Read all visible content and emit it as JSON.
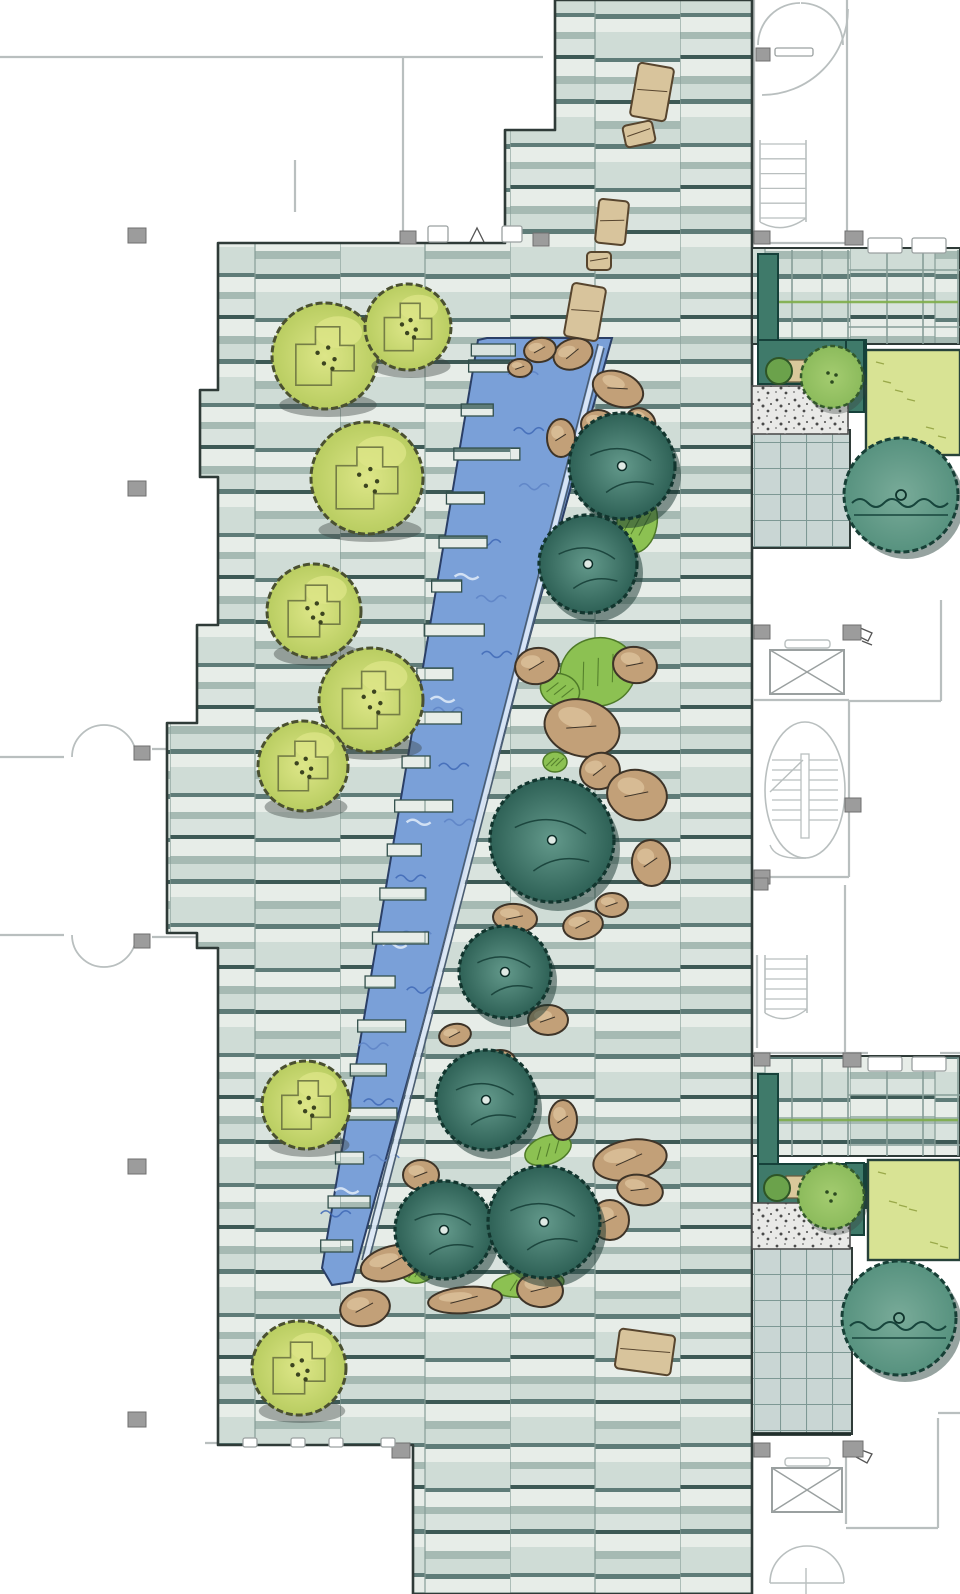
{
  "scene": {
    "width": 960,
    "height": 1594,
    "palette": {
      "paper": "#ffffff",
      "wall_line": "#b9bfbf",
      "wall_dark": "#9aa0a0",
      "column_fill": "#9c9c9c",
      "column_stroke": "#6f6f6f",
      "plaza_border": "#2f3b38",
      "band_base": "#d9e3de",
      "band_light": "#e7ede8",
      "band_mid": "#cfdcd6",
      "band_deep": "#a6bab3",
      "band_dark": "#5f7c78",
      "band_vdark": "#3d5955",
      "joint": "#869d97",
      "grid_base": "#c9d6d4",
      "grid_line": "#7d9894",
      "water": "#7aa0d8",
      "water_dark": "#3f69b6",
      "water_mid": "#5d83c6",
      "water_light": "#dce8f7",
      "water_border": "#2b3f66",
      "runnel": "#4a5d73",
      "stone_fill": "#d8c49c",
      "stone_stroke": "#57452e",
      "rock_fill": "#c2a078",
      "rock_light": "#dcc29b",
      "rock_stroke": "#3e3428",
      "grass": "#8cc152",
      "grass_stroke": "#4e7a28",
      "grass_hatch": "#55812c",
      "ltree_fill": "#b9cd61",
      "ltree_light": "#dde688",
      "ltree_stroke": "#4a5030",
      "ltree_detail": "#6b7340",
      "dtree_light": "#63998b",
      "dtree_fill": "#2e6156",
      "dtree_stroke": "#12352e",
      "mtree_fill": "#8cbb5c",
      "mtree_stroke": "#33592b",
      "btree_fill": "#57927f",
      "btree_stroke": "#173f36",
      "hedge": "#3f7a6a",
      "hedge_stroke": "#16413a",
      "lawn": "#d8e394",
      "lawn_stroke": "#9aa94a",
      "bed": "#d9c89b",
      "bed_stroke": "#6b5b3c",
      "gravel_base": "#e9e9e7",
      "gravel_dot": "#4a4a4a",
      "gravel_dot2": "#8a8a8a",
      "shadow_light": "#3a413f",
      "shadow_dark": "#16332d",
      "green_joint": "#7fae4a",
      "glyph": "#555555"
    },
    "plaza_outline": "555,0 752,0 752,1594 413,1594 413,1445 218,1445 218,948 197,948 197,933 167,933 167,723 197,723 197,625 218,625 218,477 200,477 200,390 218,390 218,243 505,243 505,130 555,130",
    "stream": {
      "polygon": "487,338 612,338 352,1282 332,1285 322,1268 478,340",
      "left_top": [
        478,
        340
      ],
      "left_bottom": [
        322,
        1268
      ],
      "teeth": [
        [
          344,
          36
        ],
        [
          360,
          46
        ],
        [
          404,
          24
        ],
        [
          448,
          58
        ],
        [
          492,
          30
        ],
        [
          536,
          40
        ],
        [
          580,
          22
        ],
        [
          624,
          52
        ],
        [
          668,
          28
        ],
        [
          712,
          44
        ],
        [
          756,
          20
        ],
        [
          800,
          50
        ],
        [
          844,
          26
        ],
        [
          888,
          38
        ],
        [
          932,
          48
        ],
        [
          976,
          22
        ],
        [
          1020,
          40
        ],
        [
          1064,
          28
        ],
        [
          1108,
          46
        ],
        [
          1152,
          20
        ],
        [
          1196,
          34
        ],
        [
          1240,
          24
        ]
      ],
      "runnel_light": [
        601,
        346,
        365,
        1262
      ],
      "runnel_dark": [
        [
          604,
          348,
          368,
          1264
        ],
        [
          598,
          344,
          362,
          1260
        ]
      ]
    },
    "stepping_stones": [
      [
        652,
        92,
        36,
        54,
        10
      ],
      [
        639,
        134,
        30,
        22,
        -12
      ],
      [
        612,
        222,
        30,
        44,
        6
      ],
      [
        599,
        261,
        24,
        18,
        0
      ],
      [
        585,
        312,
        34,
        54,
        10
      ],
      [
        645,
        1352,
        56,
        40,
        8
      ]
    ],
    "rocks": [
      [
        573,
        354,
        20,
        15,
        -20
      ],
      [
        618,
        389,
        26,
        17,
        20
      ],
      [
        598,
        424,
        17,
        14,
        0
      ],
      [
        561,
        438,
        14,
        19,
        0
      ],
      [
        641,
        421,
        15,
        12,
        30
      ],
      [
        540,
        350,
        16,
        12,
        -10
      ],
      [
        520,
        368,
        12,
        9,
        0
      ],
      [
        537,
        666,
        22,
        18,
        -10
      ],
      [
        635,
        665,
        22,
        18,
        10
      ],
      [
        582,
        728,
        38,
        28,
        15
      ],
      [
        600,
        771,
        20,
        18,
        -15
      ],
      [
        637,
        795,
        30,
        25,
        10
      ],
      [
        651,
        863,
        19,
        23,
        -5
      ],
      [
        612,
        905,
        16,
        12,
        0
      ],
      [
        583,
        925,
        20,
        14,
        -10
      ],
      [
        515,
        918,
        22,
        14,
        5
      ],
      [
        530,
        955,
        14,
        10,
        0
      ],
      [
        455,
        1035,
        16,
        11,
        -10
      ],
      [
        548,
        1020,
        20,
        15,
        0
      ],
      [
        500,
        1060,
        15,
        10,
        0
      ],
      [
        563,
        1120,
        14,
        20,
        0
      ],
      [
        630,
        1160,
        37,
        20,
        -10
      ],
      [
        640,
        1190,
        23,
        15,
        10
      ],
      [
        610,
        1220,
        19,
        20,
        0
      ],
      [
        540,
        1290,
        23,
        17,
        5
      ],
      [
        465,
        1300,
        37,
        13,
        -5
      ],
      [
        393,
        1263,
        33,
        17,
        -15
      ],
      [
        365,
        1308,
        25,
        18,
        -10
      ],
      [
        421,
        1175,
        18,
        15,
        0
      ]
    ],
    "grass_patches": [
      [
        598,
        672,
        38,
        34,
        -15
      ],
      [
        637,
        523,
        20,
        30,
        10
      ],
      [
        560,
        690,
        20,
        16,
        20
      ],
      [
        555,
        762,
        12,
        10,
        0
      ],
      [
        548,
        1150,
        24,
        14,
        -20
      ],
      [
        418,
        1272,
        16,
        11,
        -10
      ],
      [
        528,
        1284,
        36,
        13,
        -5
      ]
    ],
    "light_trees": [
      [
        325,
        356,
        53
      ],
      [
        408,
        327,
        43
      ],
      [
        367,
        478,
        56
      ],
      [
        314,
        611,
        47
      ],
      [
        371,
        700,
        52
      ],
      [
        303,
        766,
        45
      ],
      [
        306,
        1105,
        44
      ],
      [
        299,
        1368,
        47
      ]
    ],
    "dark_trees": [
      [
        622,
        466,
        53
      ],
      [
        588,
        564,
        49
      ],
      [
        552,
        840,
        62
      ],
      [
        505,
        972,
        46
      ],
      [
        486,
        1100,
        50
      ],
      [
        444,
        1230,
        49
      ],
      [
        544,
        1222,
        56
      ]
    ],
    "medium_trees": [
      [
        832,
        377,
        31
      ],
      [
        831,
        1196,
        33
      ]
    ],
    "big_teal_trees": [
      [
        901,
        495,
        57
      ],
      [
        899,
        1318,
        57
      ]
    ],
    "bushes": [
      [
        779,
        371,
        13
      ],
      [
        777,
        1188,
        13
      ]
    ],
    "hedges": [
      [
        758,
        254,
        20,
        96
      ],
      [
        758,
        340,
        108,
        44
      ],
      [
        846,
        340,
        18,
        72
      ],
      [
        758,
        1074,
        20,
        96
      ],
      [
        758,
        1164,
        108,
        44
      ],
      [
        846,
        1163,
        18,
        72
      ]
    ],
    "lawns": [
      [
        866,
        350,
        94,
        105
      ],
      [
        868,
        1160,
        92,
        100
      ]
    ],
    "planting_beds": [
      [
        782,
        360,
        30,
        22
      ],
      [
        786,
        1176,
        30,
        22
      ]
    ],
    "gravel_patches": [
      [
        752,
        386,
        96,
        48
      ],
      [
        752,
        1203,
        98,
        46
      ]
    ],
    "grid_paving": [
      [
        752,
        430,
        98,
        118
      ],
      [
        752,
        1248,
        100,
        186
      ]
    ],
    "paving_strips": [
      [
        752,
        248,
        208,
        96
      ],
      [
        752,
        1056,
        208,
        100
      ]
    ],
    "strip_vlines": [
      [
        848,
        250,
        344
      ],
      [
        887,
        250,
        344
      ],
      [
        923,
        250,
        344
      ],
      [
        958,
        250,
        344
      ],
      [
        792,
        250,
        344
      ],
      [
        822,
        250,
        344
      ],
      [
        848,
        1058,
        1156
      ],
      [
        887,
        1058,
        1156
      ],
      [
        923,
        1058,
        1156
      ],
      [
        958,
        1058,
        1156
      ],
      [
        792,
        1058,
        1156
      ],
      [
        822,
        1058,
        1156
      ]
    ],
    "strip_hlines": [
      [
        270,
        848,
        960
      ],
      [
        327,
        848,
        960
      ],
      [
        1095,
        848,
        960
      ],
      [
        1145,
        848,
        960
      ]
    ],
    "green_joints": [
      [
        760,
        302,
        958,
        302
      ],
      [
        768,
        1120,
        958,
        1120
      ]
    ],
    "walls": [
      [
        0,
        57,
        543,
        57
      ],
      [
        403,
        57,
        403,
        237
      ],
      [
        295,
        160,
        295,
        212
      ],
      [
        754,
        0,
        754,
        243
      ],
      [
        847,
        0,
        847,
        243
      ],
      [
        754,
        243,
        862,
        243
      ],
      [
        0,
        757,
        64,
        757
      ],
      [
        152,
        749,
        216,
        749
      ],
      [
        0,
        935,
        64,
        935
      ],
      [
        152,
        937,
        216,
        937
      ],
      [
        849,
        700,
        849,
        877
      ],
      [
        754,
        700,
        849,
        700
      ],
      [
        849,
        701,
        941,
        701
      ],
      [
        941,
        600,
        941,
        701
      ],
      [
        754,
        877,
        849,
        877
      ],
      [
        845,
        885,
        845,
        1053
      ],
      [
        757,
        955,
        757,
        1048
      ],
      [
        846,
        1456,
        846,
        1524
      ],
      [
        846,
        1528,
        938,
        1528
      ],
      [
        938,
        1418,
        938,
        1528
      ],
      [
        938,
        1413,
        960,
        1413
      ],
      [
        205,
        1443,
        413,
        1443
      ],
      [
        754,
        1053,
        868,
        1053
      ],
      [
        940,
        1053,
        960,
        1053
      ]
    ],
    "door_arcs": [
      "M72,757 A32,32 0 0 1 104,725",
      "M136,757 A32,32 0 0 0 104,725",
      "M72,935 A32,32 0 0 0 104,967",
      "M136,935 A32,32 0 0 1 104,967",
      "M758,45 A42,42 0 0 1 800,3",
      "M843,45 A42,42 0 0 0 801,3",
      "M762,95 A86,86 0 0 0 848,9",
      "M772,434 A44,44 0 0 0 816,478",
      "M768,1252 A40,40 0 0 0 808,1292",
      "M823,1428 A20,20 0 0 1 843,1408"
    ],
    "wall_tabs": [
      [
        428,
        226,
        20,
        16
      ],
      [
        502,
        226,
        20,
        16
      ],
      [
        775,
        48,
        38,
        8
      ],
      [
        868,
        238,
        34,
        15
      ],
      [
        912,
        238,
        34,
        15
      ],
      [
        868,
        1057,
        34,
        14
      ],
      [
        912,
        1057,
        34,
        14
      ],
      [
        243,
        1438,
        14,
        9
      ],
      [
        291,
        1438,
        14,
        9
      ],
      [
        329,
        1438,
        14,
        9
      ],
      [
        381,
        1438,
        14,
        9
      ]
    ],
    "columns": [
      [
        400,
        231,
        16,
        13
      ],
      [
        533,
        233,
        16,
        13
      ],
      [
        128,
        228,
        18,
        15
      ],
      [
        128,
        481,
        18,
        15
      ],
      [
        128,
        1159,
        18,
        15
      ],
      [
        128,
        1412,
        18,
        15
      ],
      [
        134,
        746,
        16,
        14
      ],
      [
        134,
        934,
        16,
        14
      ],
      [
        756,
        48,
        14,
        13
      ],
      [
        754,
        231,
        16,
        13
      ],
      [
        845,
        231,
        18,
        14
      ],
      [
        754,
        625,
        16,
        14
      ],
      [
        843,
        625,
        18,
        15
      ],
      [
        845,
        798,
        16,
        14
      ],
      [
        754,
        870,
        16,
        14
      ],
      [
        754,
        878,
        14,
        12
      ],
      [
        754,
        1053,
        16,
        13
      ],
      [
        843,
        1053,
        18,
        14
      ],
      [
        392,
        1443,
        18,
        15
      ],
      [
        754,
        1443,
        16,
        14
      ],
      [
        843,
        1441,
        20,
        16
      ]
    ],
    "elevators": [
      [
        770,
        650,
        74,
        44
      ],
      [
        772,
        1468,
        70,
        44
      ]
    ],
    "elevator_slots": [
      [
        785,
        640,
        45,
        8
      ],
      [
        785,
        1458,
        45,
        8
      ]
    ],
    "stair_big": {
      "ellipse": [
        805,
        790,
        40,
        68
      ],
      "treads_y": [
        760,
        770,
        780,
        790,
        800,
        810,
        820
      ],
      "tread_x": [
        772,
        838
      ],
      "stringer": [
        801,
        754,
        8,
        84
      ],
      "diag": [
        770,
        792,
        803,
        760
      ]
    },
    "stairs_small": [
      [
        760,
        140,
        46,
        82
      ],
      [
        765,
        955,
        42,
        58
      ]
    ],
    "bottom_stair": {
      "arc": "M770,1583 A37,37 0 0 1 844,1583",
      "lines": [
        [
          770,
          1583,
          844,
          1583
        ],
        [
          806,
          1568,
          806,
          1594
        ]
      ]
    },
    "glyphs": [
      "M858,627 l14,6 -4,8 -10,-5 z",
      "M862,641 l10,4",
      "M856,1448 l16,6 -5,9 -11,-6 z",
      "M470,242 l7,-14 7,14"
    ],
    "rough_edges": [
      [
        752,
        1434,
        851,
        1434
      ]
    ]
  }
}
